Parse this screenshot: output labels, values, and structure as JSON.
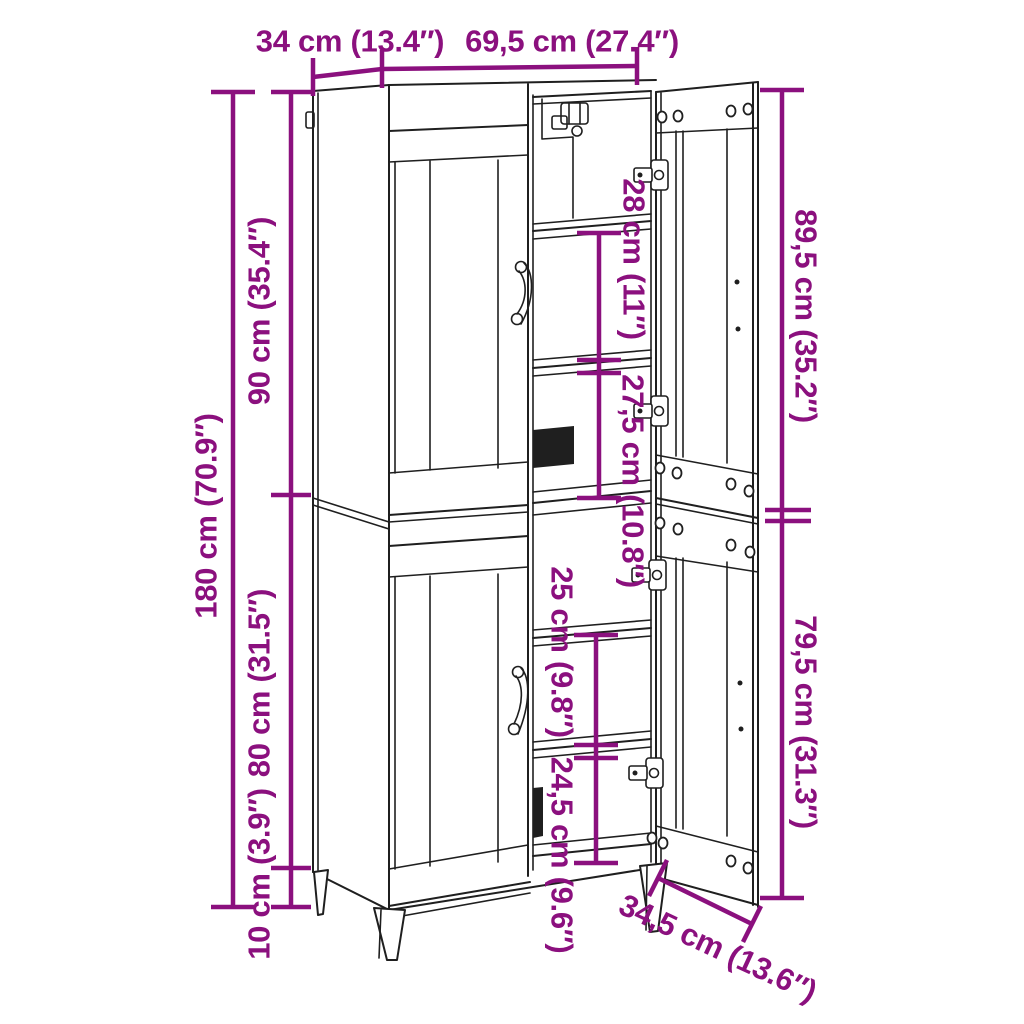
{
  "meta": {
    "title": "Cabinet dimension diagram"
  },
  "colors": {
    "accent": "#8B107E",
    "ink": "#1f1f1f",
    "background": "#ffffff"
  },
  "labels": {
    "top_depth": "34 cm (13.4″)",
    "top_width": "69,5 cm (27.4″)",
    "total_height": "180 cm (70.9″)",
    "upper_section_height": "90 cm (35.4″)",
    "lower_section_height": "80 cm (31.5″)",
    "leg_height": "10 cm (3.9″)",
    "upper_door_height": "89,5 cm (35.2″)",
    "lower_door_height": "79,5 cm (31.3″)",
    "upper_shelf_spacing_1": "28 cm (11″)",
    "upper_shelf_spacing_2": "27,5 cm (10.8″)",
    "lower_shelf_spacing_1": "25 cm (9.8″)",
    "lower_shelf_spacing_2": "24,5 cm (9.6″)",
    "door_width": "34,5 cm (13.6″)"
  }
}
